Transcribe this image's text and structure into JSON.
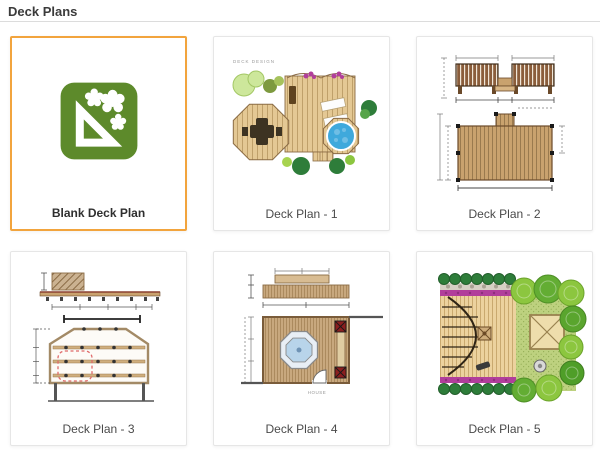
{
  "page": {
    "title": "Deck Plans"
  },
  "templates": [
    {
      "label": "Blank Deck Plan",
      "selected": true,
      "kind": "blank"
    },
    {
      "label": "Deck Plan - 1",
      "thumbnail_text": "DECK DESIGN"
    },
    {
      "label": "Deck Plan - 2"
    },
    {
      "label": "Deck Plan - 3"
    },
    {
      "label": "Deck Plan - 4",
      "thumbnail_text": "HOUSE"
    },
    {
      "label": "Deck Plan - 5"
    }
  ],
  "colors": {
    "selected_border": "#F2A43D",
    "card_border": "#E6E6E6",
    "blank_icon_green": "#5D8A2B",
    "deck_wood": "#E4C894",
    "plan_wood": "#C9A26E",
    "spa_blue": "#3FA9DC",
    "tree_green": "#8CC63F",
    "dark_fern_green": "#2E7D3A",
    "flower_purple": "#B13E9B",
    "highlight_red": "#E06A6A"
  }
}
